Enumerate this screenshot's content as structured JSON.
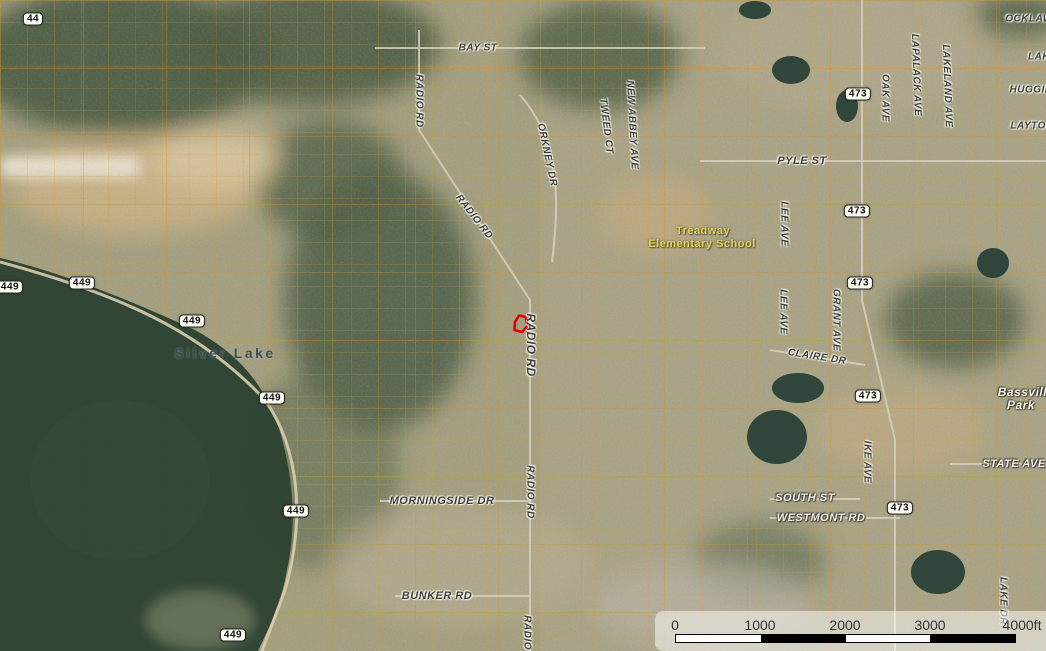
{
  "map": {
    "description": "Aerial parcel map, Silver Lake / Bassville Park area, with parcel boundaries and a selected parcel highlighted in red",
    "colors": {
      "parcel_line": "#DD9E33",
      "selected_parcel_outline": "#E00000",
      "water": "#2E4334",
      "route_shield_bg": "#FDFDF4",
      "street_label_dark": "#3E3E36",
      "street_label_white": "#F7F3E8",
      "school_label": "#E8D64D",
      "scale_panel": "rgba(255,255,255,0.5)"
    },
    "place_labels": [
      {
        "text": "Silver Lake",
        "x": 225,
        "y": 353,
        "rot": 0,
        "cls": "water-name",
        "size": 14
      },
      {
        "text": "Treadway",
        "x": 703,
        "y": 231,
        "rot": 0,
        "cls": "school",
        "size": 11
      },
      {
        "text": "Elementary School",
        "x": 702,
        "y": 244,
        "rot": 0,
        "cls": "school",
        "size": 11
      },
      {
        "text": "Bassville",
        "x": 1026,
        "y": 392,
        "rot": 0,
        "cls": "white",
        "size": 12
      },
      {
        "text": "Park",
        "x": 1021,
        "y": 405,
        "rot": 0,
        "cls": "white",
        "size": 12
      }
    ],
    "street_labels": [
      {
        "text": "BAY ST",
        "x": 478,
        "y": 48,
        "rot": 0,
        "cls": "dark",
        "size": 10
      },
      {
        "text": "RADIO RD",
        "x": 419,
        "y": 101,
        "rot": 90,
        "cls": "dark",
        "size": 10
      },
      {
        "text": "RADIO RD",
        "x": 474,
        "y": 217,
        "rot": 52,
        "cls": "dark",
        "size": 10
      },
      {
        "text": "ORKNEY DR",
        "x": 547,
        "y": 155,
        "rot": 78,
        "cls": "dark",
        "size": 10
      },
      {
        "text": "TWEED CT",
        "x": 606,
        "y": 126,
        "rot": 83,
        "cls": "dark",
        "size": 10
      },
      {
        "text": "NEW ABBEY AVE",
        "x": 632,
        "y": 125,
        "rot": 87,
        "cls": "dark",
        "size": 10
      },
      {
        "text": "OAK AVE",
        "x": 885,
        "y": 98,
        "rot": 90,
        "cls": "dark",
        "size": 10
      },
      {
        "text": "LAPALACK AVE",
        "x": 916,
        "y": 75,
        "rot": 88,
        "cls": "dark",
        "size": 10
      },
      {
        "text": "LAKELAND AVE",
        "x": 947,
        "y": 86,
        "rot": 88,
        "cls": "dark",
        "size": 10
      },
      {
        "text": "OCKLAW",
        "x": 1029,
        "y": 19,
        "rot": 0,
        "cls": "dark",
        "size": 10
      },
      {
        "text": "LAK",
        "x": 1039,
        "y": 57,
        "rot": 0,
        "cls": "dark",
        "size": 10
      },
      {
        "text": "HUGGIN",
        "x": 1031,
        "y": 90,
        "rot": 0,
        "cls": "dark",
        "size": 10
      },
      {
        "text": "LAYTON",
        "x": 1032,
        "y": 126,
        "rot": 0,
        "cls": "dark",
        "size": 10
      },
      {
        "text": "PYLE ST",
        "x": 802,
        "y": 161,
        "rot": 0,
        "cls": "dark",
        "size": 11
      },
      {
        "text": "LEE AVE",
        "x": 784,
        "y": 224,
        "rot": 90,
        "cls": "dark",
        "size": 10
      },
      {
        "text": "LEE AVE",
        "x": 783,
        "y": 312,
        "rot": 90,
        "cls": "dark",
        "size": 10
      },
      {
        "text": "GRANT AVE",
        "x": 836,
        "y": 320,
        "rot": 90,
        "cls": "dark",
        "size": 10
      },
      {
        "text": "CLAIRE DR",
        "x": 817,
        "y": 357,
        "rot": 9,
        "cls": "dark",
        "size": 10
      },
      {
        "text": "IKE AVE",
        "x": 867,
        "y": 462,
        "rot": 90,
        "cls": "dark",
        "size": 10
      },
      {
        "text": "RADIO RD",
        "x": 531,
        "y": 345,
        "rot": 90,
        "cls": "dark",
        "size": 12
      },
      {
        "text": "RADIO RD",
        "x": 530,
        "y": 492,
        "rot": 90,
        "cls": "dark",
        "size": 10
      },
      {
        "text": "MORNINGSIDE DR",
        "x": 442,
        "y": 501,
        "rot": 0,
        "cls": "dark",
        "size": 11
      },
      {
        "text": "BUNKER RD",
        "x": 437,
        "y": 596,
        "rot": 0,
        "cls": "dark",
        "size": 11
      },
      {
        "text": "RADIO RD",
        "x": 527,
        "y": 642,
        "rot": 90,
        "cls": "dark",
        "size": 10
      },
      {
        "text": "SOUTH ST",
        "x": 805,
        "y": 498,
        "rot": 0,
        "cls": "white",
        "size": 11
      },
      {
        "text": "WESTMONT RD",
        "x": 821,
        "y": 518,
        "rot": 0,
        "cls": "white",
        "size": 11
      },
      {
        "text": "STATE AVE",
        "x": 1014,
        "y": 464,
        "rot": 0,
        "cls": "white",
        "size": 11
      },
      {
        "text": "LAKE DR",
        "x": 1003,
        "y": 601,
        "rot": 90,
        "cls": "dark",
        "size": 10
      }
    ],
    "route_shields": [
      {
        "label": "44",
        "x": 33,
        "y": 19
      },
      {
        "label": "449",
        "x": 10,
        "y": 287
      },
      {
        "label": "449",
        "x": 82,
        "y": 283
      },
      {
        "label": "449",
        "x": 192,
        "y": 321
      },
      {
        "label": "449",
        "x": 272,
        "y": 398
      },
      {
        "label": "449",
        "x": 296,
        "y": 511
      },
      {
        "label": "449",
        "x": 233,
        "y": 635
      },
      {
        "label": "473",
        "x": 858,
        "y": 94
      },
      {
        "label": "473",
        "x": 857,
        "y": 211
      },
      {
        "label": "473",
        "x": 860,
        "y": 283
      },
      {
        "label": "473",
        "x": 868,
        "y": 396
      },
      {
        "label": "473",
        "x": 900,
        "y": 508
      }
    ],
    "selected_parcel": {
      "points": "515,322 519,315.5 525.5,317 527.5,326 522,332 514.5,330",
      "stroke": "#E00000"
    }
  },
  "scale_bar": {
    "ticks": [
      {
        "label": "0",
        "x": 20
      },
      {
        "label": "1000",
        "x": 105
      },
      {
        "label": "2000",
        "x": 190
      },
      {
        "label": "3000",
        "x": 275
      },
      {
        "label": "4000ft",
        "x": 367
      }
    ],
    "segments": [
      "w",
      "b",
      "w",
      "b"
    ]
  }
}
